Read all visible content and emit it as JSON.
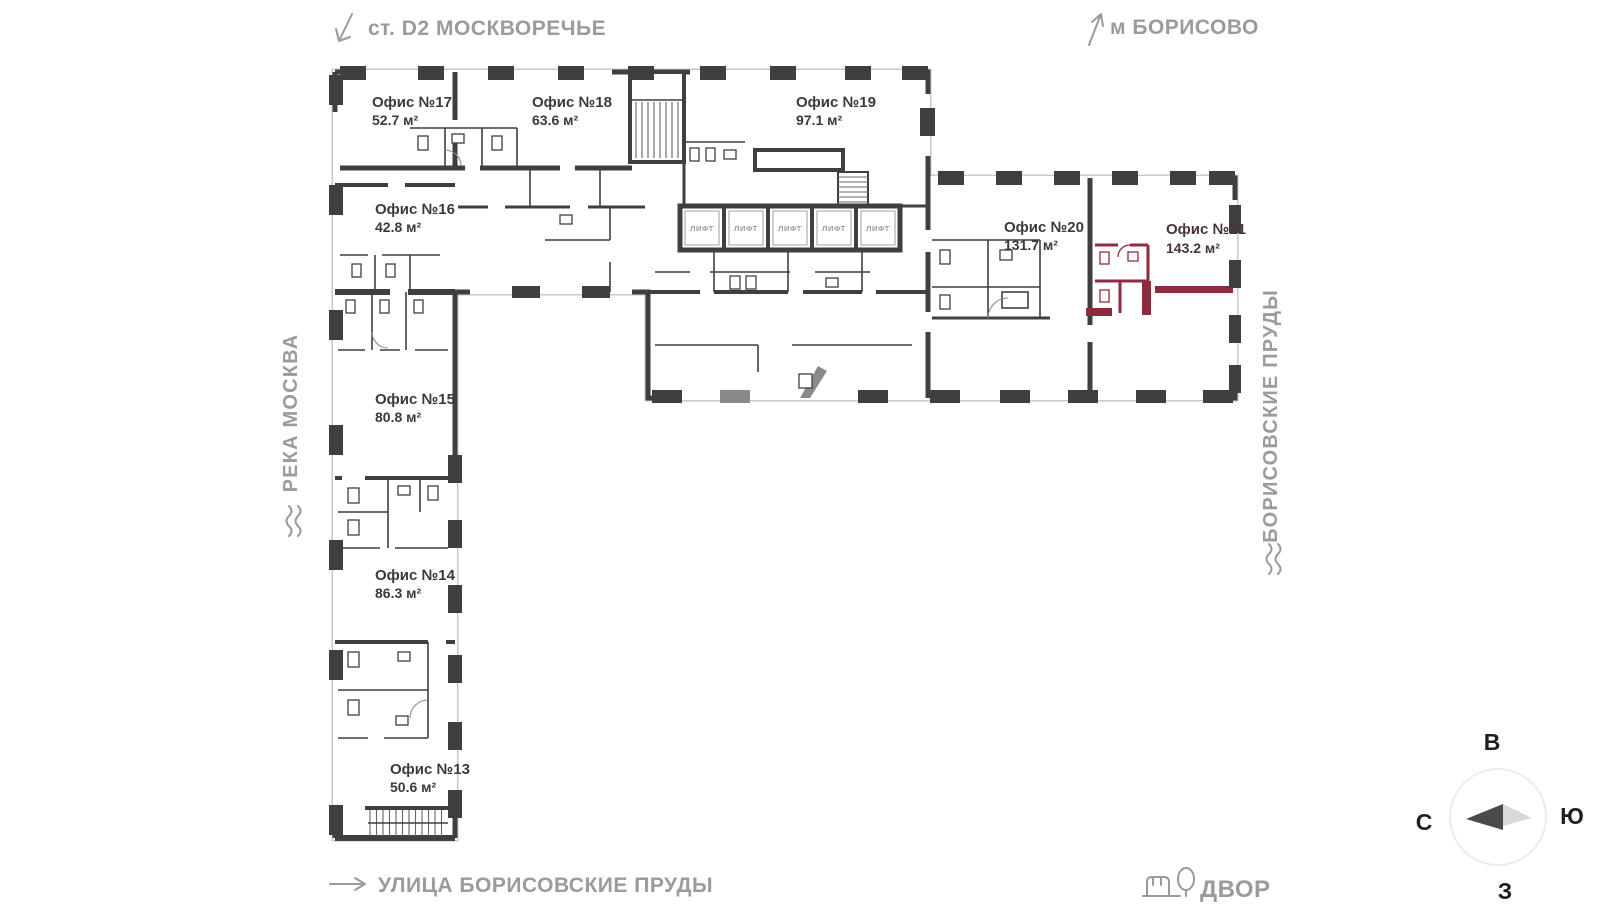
{
  "landmarks": {
    "top_left": "ст. D2 МОСКВОРЕЧЬЕ",
    "top_right": "м БОРИСОВО",
    "left": "РЕКА МОСКВА",
    "right": "БОРИСОВСКИЕ ПРУДЫ",
    "bottom": "УЛИЦА БОРИСОВСКИЕ ПРУДЫ",
    "yard": "ДВОР"
  },
  "compass": {
    "east": "В",
    "south": "Ю",
    "north": "С",
    "west": "З"
  },
  "labels": {
    "lift": "ЛИФТ"
  },
  "offices": [
    {
      "id": 13,
      "name": "Офис №13",
      "area": "50.6 м²",
      "highlighted": false
    },
    {
      "id": 14,
      "name": "Офис №14",
      "area": "86.3 м²",
      "highlighted": false
    },
    {
      "id": 15,
      "name": "Офис №15",
      "area": "80.8 м²",
      "highlighted": false
    },
    {
      "id": 16,
      "name": "Офис №16",
      "area": "42.8 м²",
      "highlighted": false
    },
    {
      "id": 17,
      "name": "Офис №17",
      "area": "52.7 м²",
      "highlighted": false
    },
    {
      "id": 18,
      "name": "Офис №18",
      "area": "63.6 м²",
      "highlighted": false
    },
    {
      "id": 19,
      "name": "Офис №19",
      "area": "97.1 м²",
      "highlighted": false
    },
    {
      "id": 20,
      "name": "Офис №20",
      "area": "131.7 м²",
      "highlighted": false
    },
    {
      "id": 21,
      "name": "Офис №21",
      "area": "143.2 м²",
      "highlighted": true
    }
  ],
  "colors": {
    "wall": "#3F3F3F",
    "window": "#C9C9C9",
    "highlight_fill": "#EFA0AC",
    "highlight_fill_light": "#F5C7CE",
    "highlight_wall": "#8E2B3C",
    "highlight_text": "#4A3238",
    "landmark_text": "#9B9B9B",
    "office_text": "#3A3A3A"
  }
}
